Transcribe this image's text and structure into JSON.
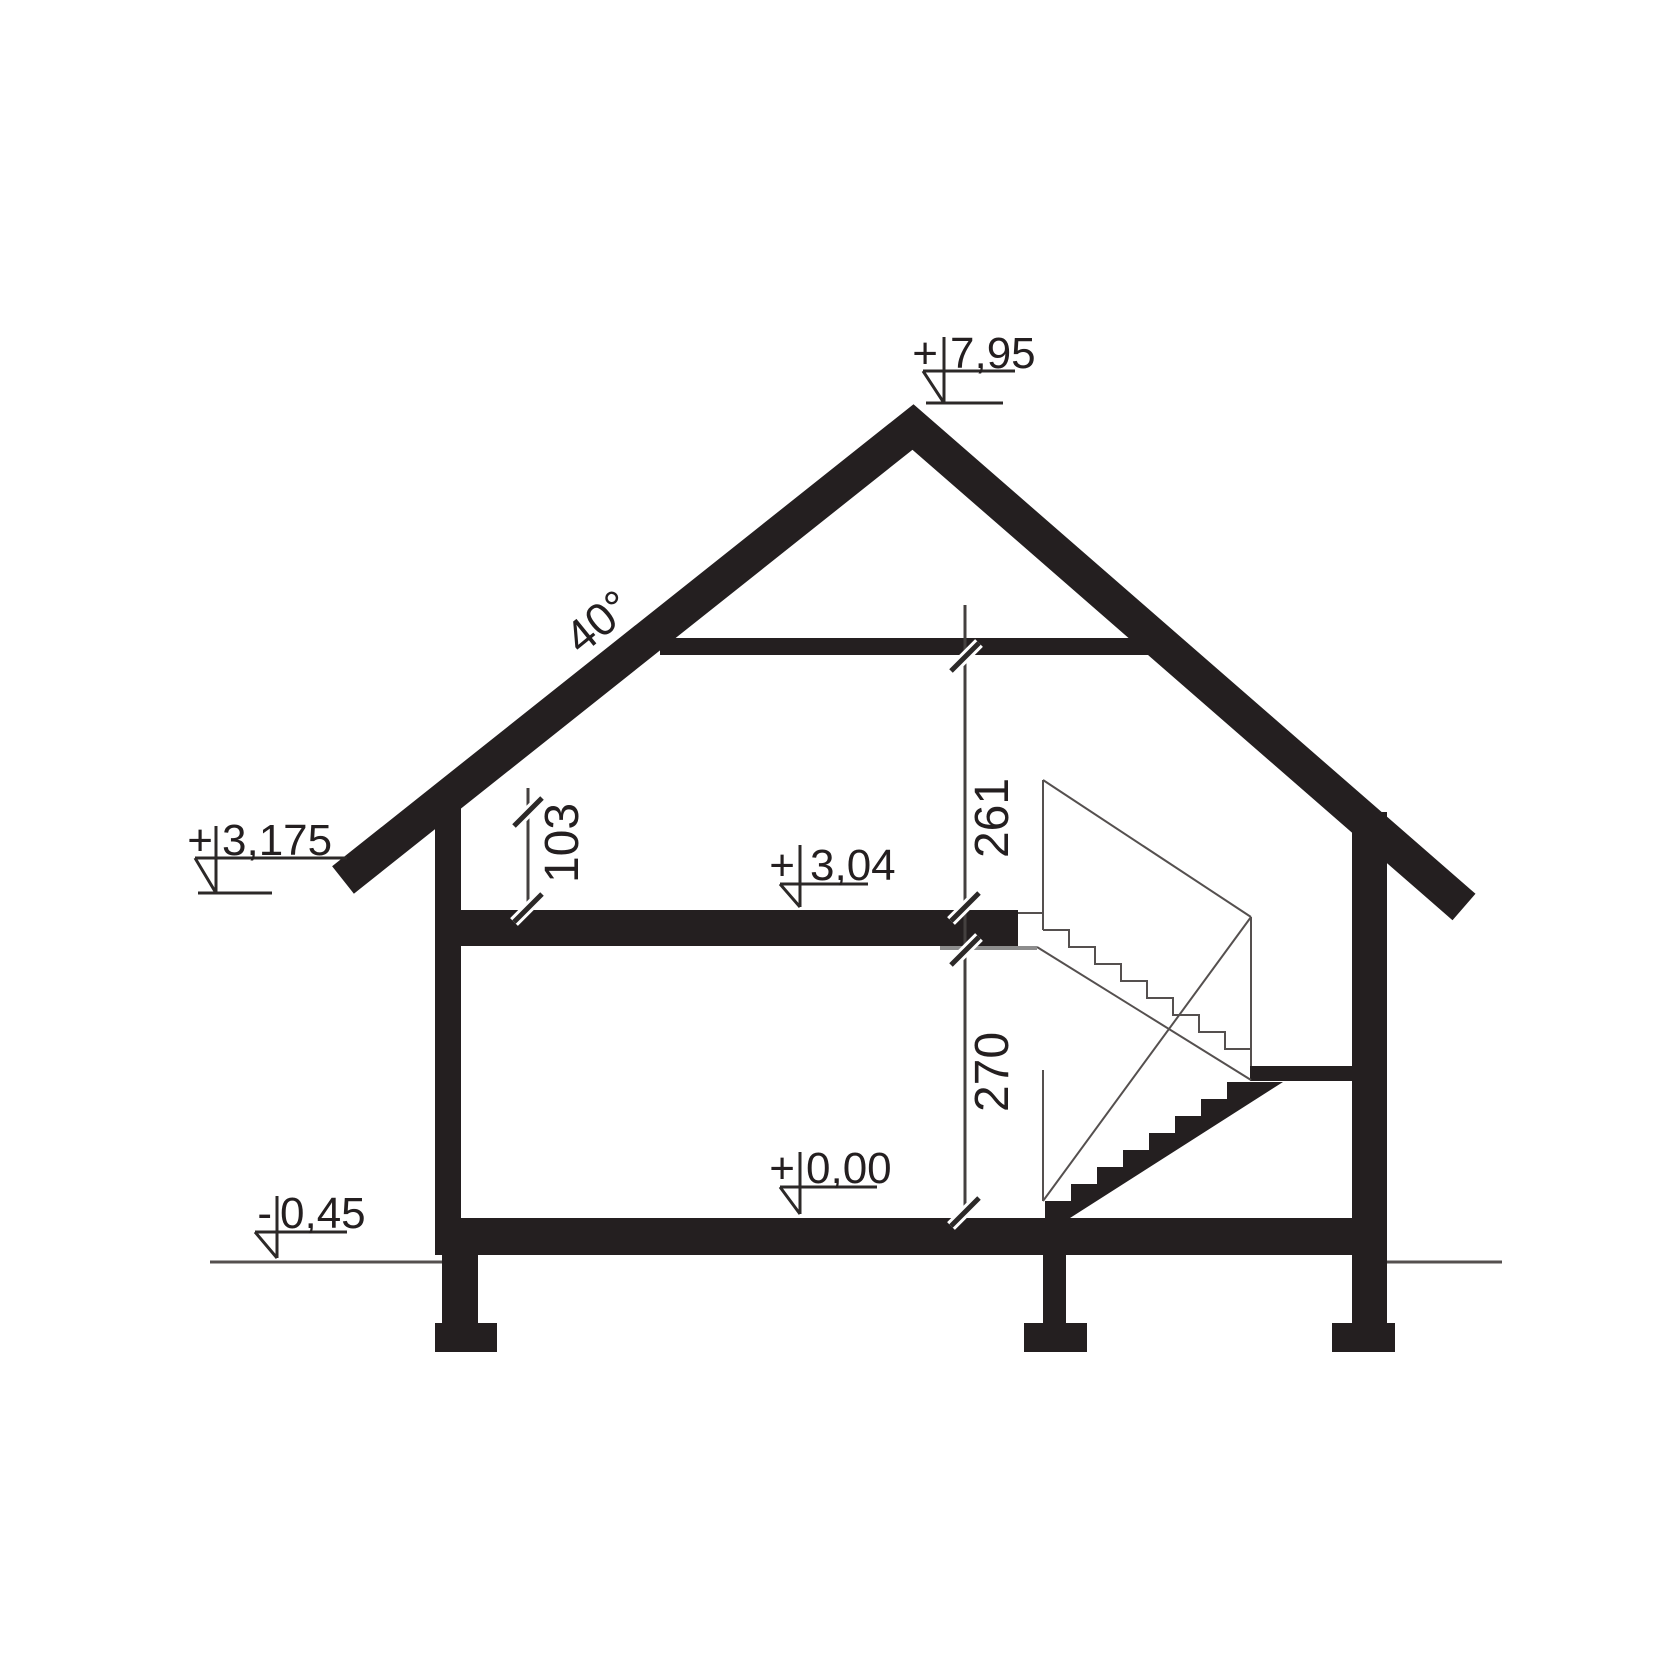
{
  "drawing": {
    "type": "architectural-cross-section",
    "ink_color": "#241f20",
    "roof_angle_label": "40°",
    "levels": [
      {
        "name": "ridge",
        "sign": "+",
        "value": "7,95"
      },
      {
        "name": "eaves",
        "sign": "+",
        "value": "3,175"
      },
      {
        "name": "attic_floor",
        "sign": "+",
        "value": "3,04"
      },
      {
        "name": "ground_floor",
        "sign": "+",
        "value": "0,00"
      },
      {
        "name": "grade",
        "sign": "-",
        "value": "0,45"
      }
    ],
    "room_dimensions": [
      {
        "name": "knee_wall_height",
        "value": "103"
      },
      {
        "name": "attic_room_height",
        "value": "261"
      },
      {
        "name": "ground_room_height",
        "value": "270"
      }
    ]
  }
}
